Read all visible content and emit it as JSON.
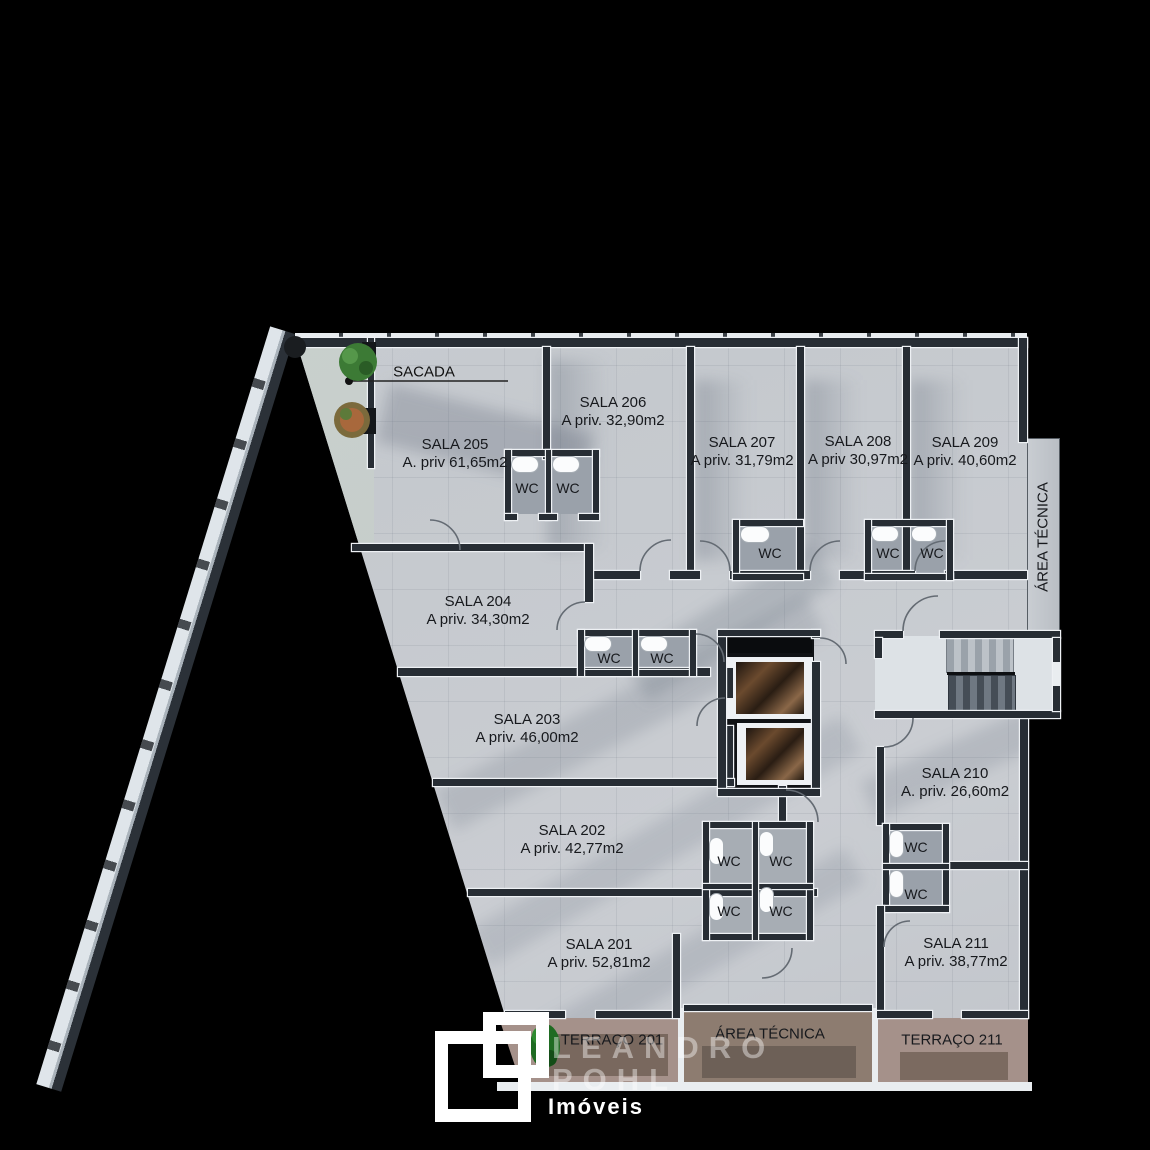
{
  "labels": {
    "sacada": "SACADA",
    "wc": "WC",
    "area_tecnica_vertical": "ÁREA TÉCNICA",
    "area_tecnica_bottom": "ÁREA TÉCNICA",
    "terraco_201": "TERRAÇO 201",
    "terraco_211": "TERRAÇO 211"
  },
  "rooms": [
    {
      "name": "SALA 201",
      "area": "A priv. 52,81m2"
    },
    {
      "name": "SALA 202",
      "area": "A priv. 42,77m2"
    },
    {
      "name": "SALA 203",
      "area": "A priv. 46,00m2"
    },
    {
      "name": "SALA 204",
      "area": "A priv. 34,30m2"
    },
    {
      "name": "SALA 205",
      "area": "A. priv 61,65m2"
    },
    {
      "name": "SALA 206",
      "area": "A priv. 32,90m2"
    },
    {
      "name": "SALA 207",
      "area": "A priv. 31,79m2"
    },
    {
      "name": "SALA 208",
      "area": "A priv 30,97m2"
    },
    {
      "name": "SALA 209",
      "area": "A priv. 40,60m2"
    },
    {
      "name": "SALA 210",
      "area": "A. priv. 26,60m2"
    },
    {
      "name": "SALA 211",
      "area": "A priv. 38,77m2"
    }
  ],
  "watermark": {
    "name_line1": "LEANDRO",
    "name_line2": "POHL",
    "tagline": "Imóveis"
  },
  "colors": {
    "background": "#000000",
    "floor": "#c6cad0",
    "wall": "#272d34",
    "terrace_outer": "#a39086",
    "terrace_inner": "#7b6b61",
    "watermark": "#ffffff",
    "tree_green": "#2f6b2d"
  }
}
